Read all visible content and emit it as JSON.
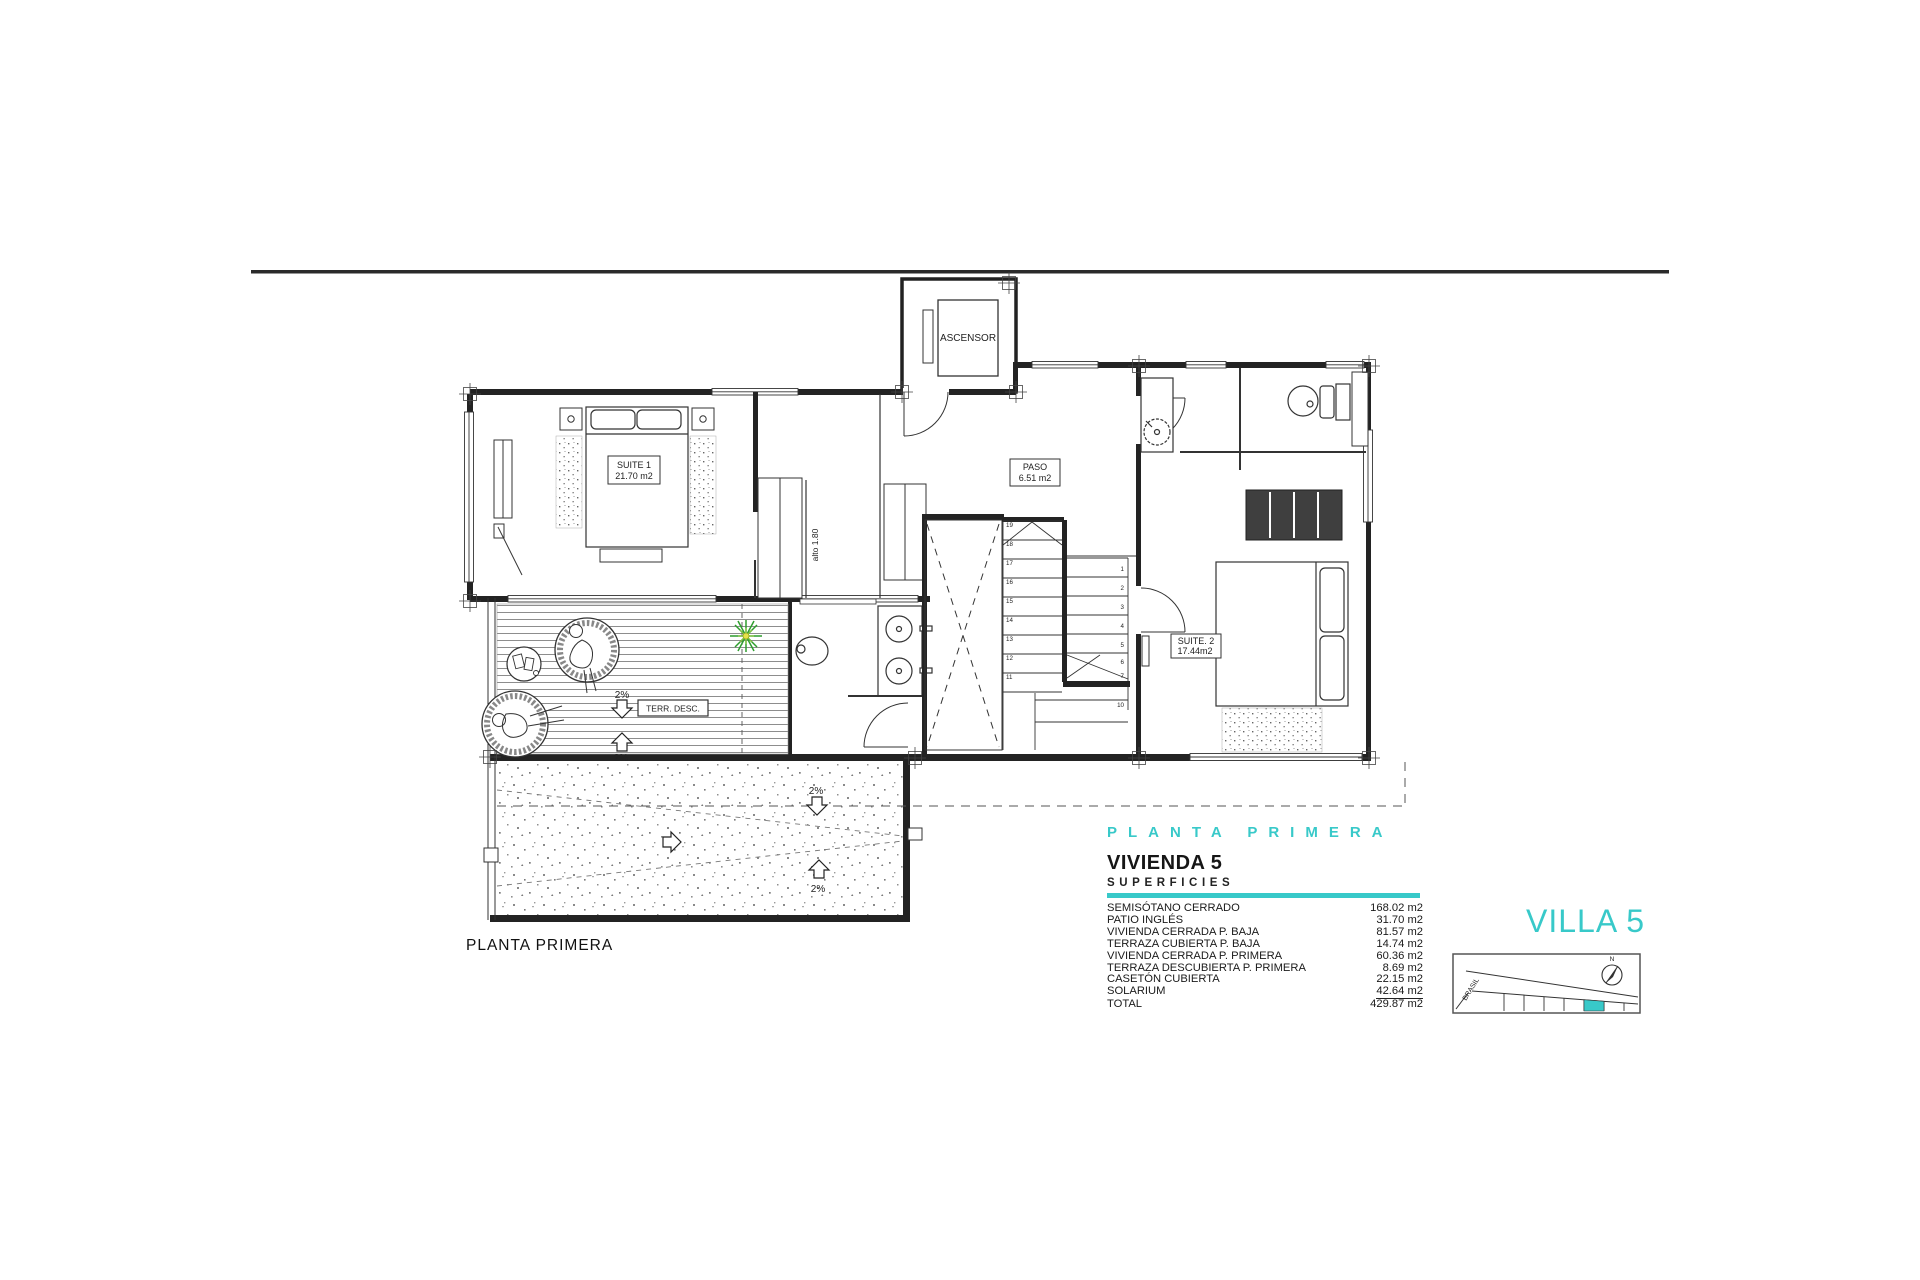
{
  "plan": {
    "caption": "PLANTA PRIMERA",
    "elevator_label": "ASCENSOR",
    "alto_label": "alto 1.80",
    "rooms": {
      "suite1_name": "SUITE 1",
      "suite1_area": "21.70 m2",
      "paso_name": "PASO",
      "paso_area": "6.51 m2",
      "suite2_name": "SUITE. 2",
      "suite2_area": "17.44m2",
      "terrace_label": "TERR. DESC."
    },
    "slopes": {
      "terrace_down": "2%",
      "terrace_up": "2%",
      "patio_down": "2%",
      "patio_up": "2%"
    },
    "stairs": {
      "left": [
        "19",
        "18",
        "17",
        "16",
        "15",
        "14",
        "13",
        "12",
        "11"
      ],
      "right": [
        "1",
        "2",
        "3",
        "4",
        "5",
        "6",
        "7",
        "10"
      ]
    }
  },
  "legend": {
    "floor_title": "PLANTA PRIMERA",
    "unit_title": "VIVIENDA 5",
    "section_title": "SUPERFICIES",
    "rows": [
      {
        "label": "SEMISÓTANO CERRADO",
        "value": "168.02 m2"
      },
      {
        "label": "PATIO INGLÉS",
        "value": "31.70 m2"
      },
      {
        "label": "VIVIENDA CERRADA P. BAJA",
        "value": "81.57 m2"
      },
      {
        "label": "TERRAZA CUBIERTA P. BAJA",
        "value": "14.74 m2"
      },
      {
        "label": "VIVIENDA CERRADA P. PRIMERA",
        "value": "60.36 m2"
      },
      {
        "label": "TERRAZA DESCUBIERTA P. PRIMERA",
        "value": "8.69 m2"
      },
      {
        "label": "CASETÓN CUBIERTA",
        "value": "22.15 m2"
      },
      {
        "label": "SOLARIUM",
        "value": "42.64 m2"
      },
      {
        "label": "TOTAL",
        "value": "429.87 m2"
      }
    ],
    "villa_title": "VILLA 5"
  },
  "site_map": {
    "street_label": "BRASIL",
    "north_label": "N"
  },
  "colors": {
    "accent": "#38C9C9"
  }
}
